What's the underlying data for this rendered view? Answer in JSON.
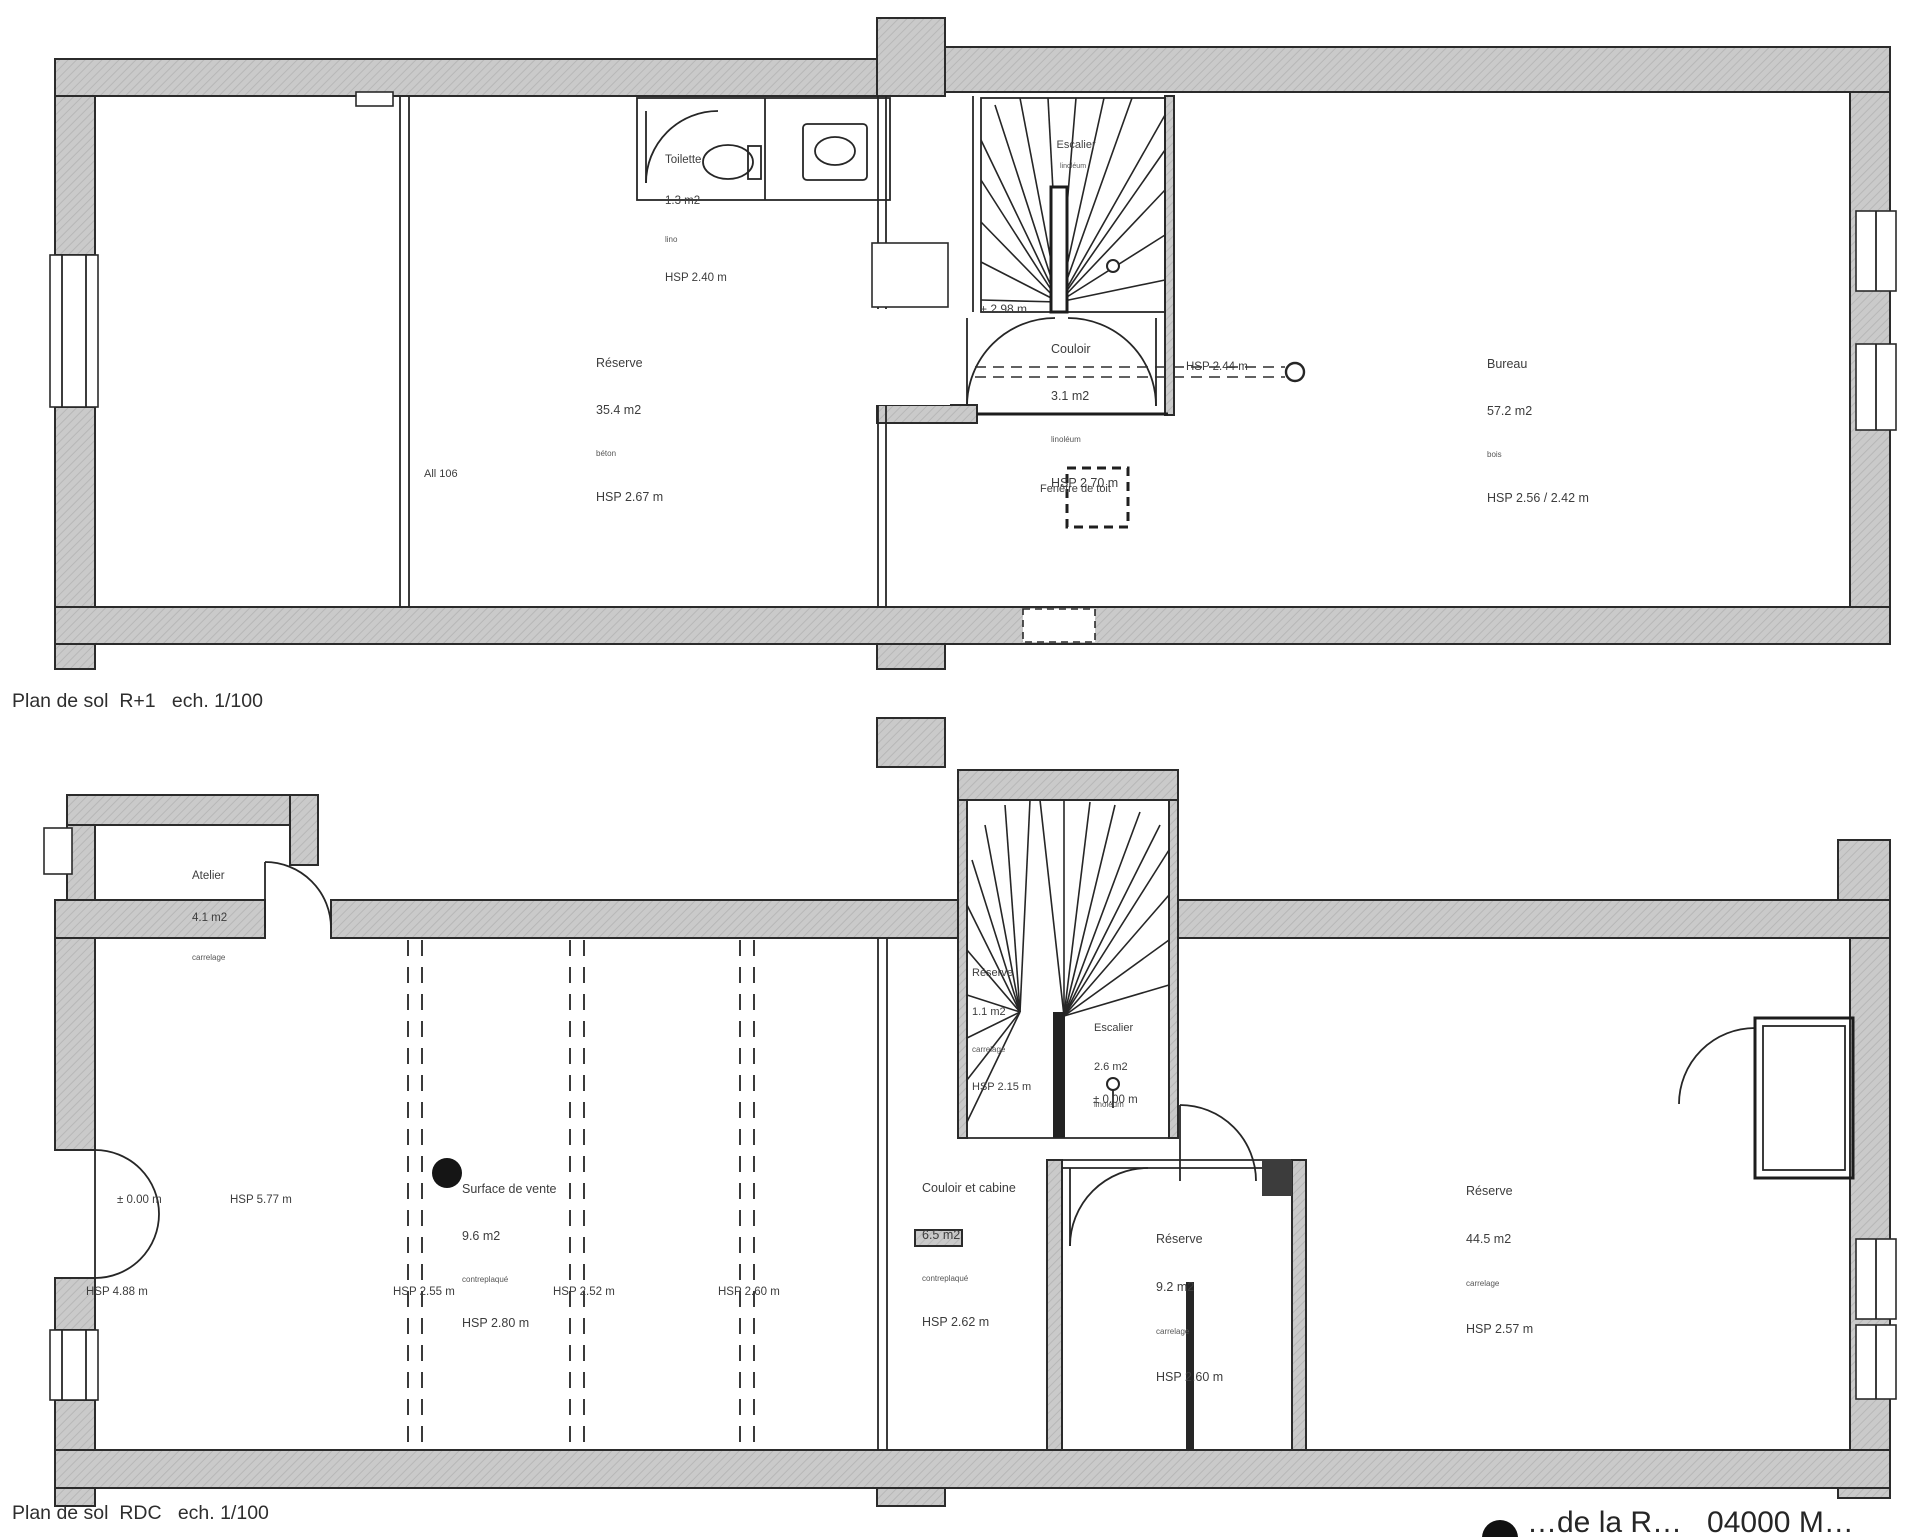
{
  "sheet": {
    "wall_fill_color": "#cacaca",
    "line_color": "#2b2b2b",
    "text_color": "#3d3d3d"
  },
  "plan_r1": {
    "caption": "Plan de sol  R+1   ech. 1/100",
    "rooms": {
      "toilette": {
        "name": "Toilette",
        "area": "1.3 m2",
        "floor": "lino",
        "hsp": "HSP 2.40 m"
      },
      "reserve": {
        "name": "Réserve",
        "area": "35.4 m2",
        "floor": "béton",
        "hsp": "HSP 2.67 m"
      },
      "couloir": {
        "name": "Couloir",
        "area": "3.1 m2",
        "floor": "linoléum",
        "hsp": "HSP 2.70 m"
      },
      "bureau": {
        "name": "Bureau",
        "area": "57.2 m2",
        "floor": "bois",
        "hsp": "HSP 2.56 / 2.42 m"
      },
      "escalier": {
        "name": "Escalier",
        "floor": "linoléum"
      }
    },
    "annotations": {
      "all106": "All 106",
      "level": "+ 2.98 m",
      "hsp_dash": "HSP 2.44 m",
      "fenetre_toit": "Fenêtre de toit"
    }
  },
  "plan_rdc": {
    "caption": "Plan de sol  RDC   ech. 1/100",
    "rooms": {
      "atelier_ext": {
        "name": "Atelier",
        "area": "4.1 m2",
        "floor": "carrelage"
      },
      "surface_vente": {
        "name": "Surface de vente",
        "area": "9.6 m2",
        "floor": "contreplaqué",
        "hsp": "HSP 2.80 m"
      },
      "reserve_stair": {
        "name": "Réserve",
        "area": "1.1 m2",
        "floor": "carrelage",
        "hsp": "HSP 2.15 m"
      },
      "escalier": {
        "name": "Escalier",
        "area": "2.6 m2",
        "floor": "linoléum"
      },
      "couloir_cabine": {
        "name": "Couloir et cabine",
        "area": "6.5 m2",
        "floor": "contreplaqué",
        "hsp": "HSP 2.62 m"
      },
      "reserve_9": {
        "name": "Réserve",
        "area": "9.2 m2",
        "floor": "carrelage",
        "hsp": "HSP 2.60 m"
      },
      "reserve_44": {
        "name": "Réserve",
        "area": "44.5 m2",
        "floor": "carrelage",
        "hsp": "HSP 2.57 m"
      }
    },
    "annotations": {
      "level_entry": "± 0.00 m",
      "hsp_entry": "HSP 5.77 m",
      "level_stair": "± 0.00 m",
      "hsp_1": "HSP 4.88 m",
      "hsp_2": "HSP 2.55 m",
      "hsp_3": "HSP 2.52 m",
      "hsp_4": "HSP 2.60 m"
    }
  },
  "title_block": {
    "text": "…de la R…   04000 M…"
  }
}
